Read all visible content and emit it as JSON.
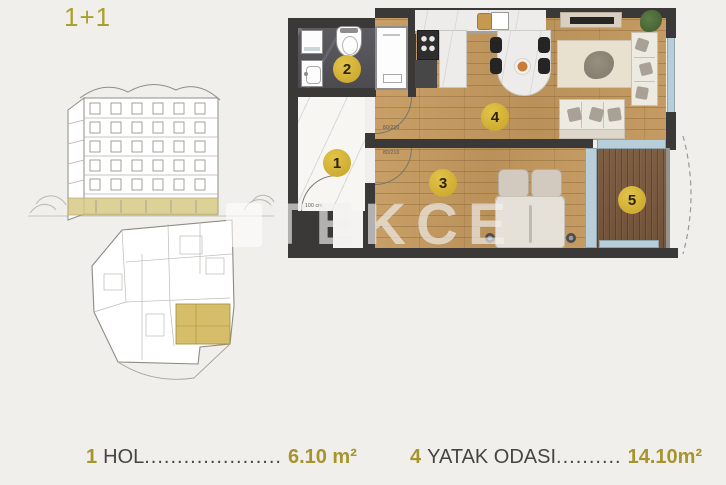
{
  "title": "1+1",
  "watermark": {
    "text": "TEKCE"
  },
  "plan": {
    "markers": [
      {
        "num": "1"
      },
      {
        "num": "2"
      },
      {
        "num": "3"
      },
      {
        "num": "4"
      },
      {
        "num": "5"
      }
    ],
    "dimension_labels": {
      "entrance": "100 cm",
      "living_door": "80/210",
      "bedroom_door": "80/210"
    }
  },
  "legend": [
    {
      "num": "1",
      "name": "HOL",
      "dots": ".....................",
      "area": "6.10 m²"
    },
    {
      "num": "4",
      "name": "YATAK ODASI",
      "dots": "..........",
      "area": "14.10m²"
    }
  ],
  "colors": {
    "accent_gold": "#a6952f",
    "marker_fill": "#d2af30",
    "wall": "#3b3937",
    "window_blue": "#b9cedb",
    "wood_floor": "#c89f66",
    "balcony_deck": "#7e5e43"
  }
}
